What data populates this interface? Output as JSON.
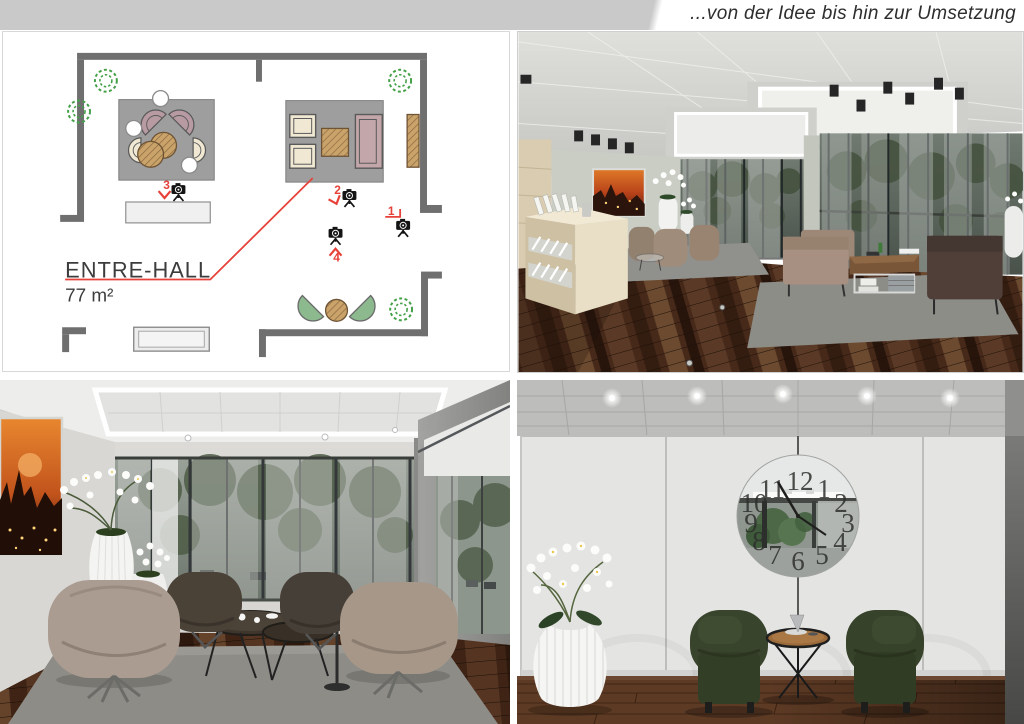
{
  "page": {
    "tagline": "...von der Idee bis hin zur Umsetzung",
    "band_color": "#c9c9c9",
    "background": "#ffffff"
  },
  "floor_plan": {
    "room_name": "ENTRE-HALL",
    "area_label": "77 m²",
    "cameras": [
      {
        "number": "1"
      },
      {
        "number": "2"
      },
      {
        "number": "3"
      },
      {
        "number": "4"
      }
    ],
    "colors": {
      "wall_gray": "#6f6f6f",
      "annotation_red": "#e6423a",
      "rug_gray": "#9e9e9e",
      "wood_tan": "#c9a369",
      "plant_green": "#43a047",
      "chair_mauve": "#b89aa2",
      "chair_cream": "#f0e8d2",
      "chair_green": "#8cba8e"
    }
  },
  "renders": {
    "bottom_right": {
      "clock_numerals": [
        "12",
        "1",
        "2",
        "3",
        "4",
        "5",
        "6",
        "7",
        "8",
        "9",
        "10",
        "11"
      ]
    }
  }
}
